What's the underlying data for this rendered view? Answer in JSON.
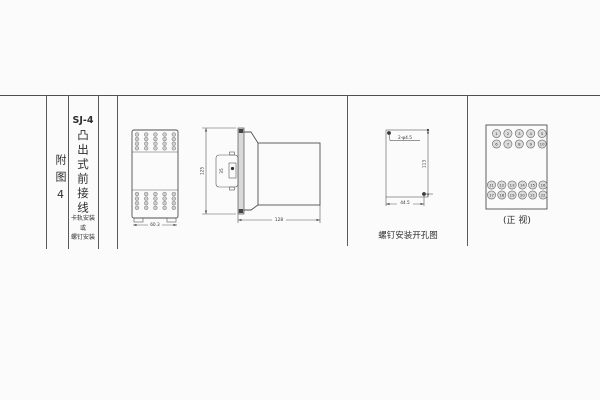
{
  "colors": {
    "line": "#4f4f4f",
    "text": "#333333",
    "fill_light": "#dcdcdc"
  },
  "left_panel": {
    "appendix_label": "附图4",
    "model": "SJ-4",
    "wiring_type": "凸出式前接线",
    "mount_lines": {
      "l1": "卡轨安装",
      "l2": "或",
      "l3": "螺钉安装"
    }
  },
  "front_view": {
    "width_dim": "60.3"
  },
  "side_view": {
    "height_dim": "125",
    "bracket_dim": "35",
    "depth_dim": "128"
  },
  "drill_view": {
    "holes_label": "2-φ4.5",
    "vertical_dim": "113",
    "horizontal_dim": "44.5",
    "caption": "螺钉安装开孔图"
  },
  "panel_view": {
    "caption": "(正 视)",
    "top_terminals": [
      [
        "1",
        "2",
        "3",
        "4",
        "5"
      ],
      [
        "6",
        "7",
        "8",
        "9",
        "10"
      ]
    ],
    "bottom_terminals": [
      [
        "11",
        "12",
        "13",
        "14",
        "15",
        "16"
      ],
      [
        "17",
        "18",
        "19",
        "20",
        "21",
        "22"
      ]
    ]
  }
}
